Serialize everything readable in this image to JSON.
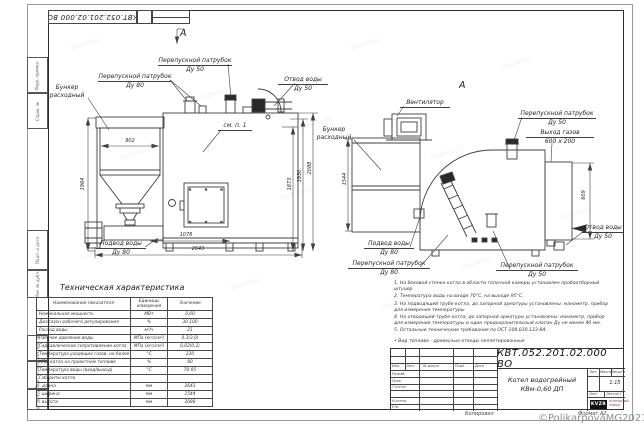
{
  "sheet": {
    "doc_number": "КВТ.052.201.02.000  ВО",
    "doc_number_top": "КВТ.052.201.02.000  ВО",
    "product_name_line1": "Котел водогрейный",
    "product_name_line2": "КВм-0,60  ДП",
    "scale_value": "1:15",
    "copied": "Копировал",
    "format": "Формат А2",
    "stamp": {
      "header_cols": {
        "izm": "Изм.",
        "list": "Лист",
        "doc": "№ докум.",
        "podp": "Подп.",
        "data": "Дата"
      },
      "rows": {
        "r1": "Разраб.",
        "r2": "Пров.",
        "r3": "Т.контр.",
        "r4": "Н.контр.",
        "r5": "Утв."
      },
      "lit": "Лит.",
      "mass": "Масса",
      "scale": "Масштаб",
      "sheet": "Лист",
      "sheets": "Листов 1"
    },
    "logo": {
      "text": "KVZR",
      "caption1": "КОТЕЛЬНЫЙ",
      "caption2": "ЗАВОД"
    },
    "margin_labels": {
      "m1": "Перв. примен.",
      "m2": "Справ. №",
      "m3": "Подп. и дата",
      "m4": "Инв. № дубл.",
      "m5": "Взам. инв. №",
      "m6": "Подп. и дата",
      "m7": "Инв. № подл."
    }
  },
  "view1": {
    "arrow_label": "А",
    "see_note": "см. п. 1",
    "labels": {
      "bunker": {
        "l1": "Бункер",
        "l2": "расходный"
      },
      "bypass80": {
        "l1": "Перепускной патрубок",
        "l2": "Ду 80"
      },
      "bypass50": {
        "l1": "Перепускной патрубок",
        "l2": "Ду 50"
      },
      "water_out": {
        "l1": "Отвод воды",
        "l2": "Ду 50"
      },
      "water_in": {
        "l1": "Подвод воды",
        "l2": "Ду 80"
      }
    },
    "dims": {
      "bunker_width": "902",
      "height_left": "1964",
      "h1873": "1873",
      "h1930": "1930",
      "h2088": "2088",
      "len1078": "1078",
      "len2643": "2643"
    }
  },
  "view2": {
    "title": "А",
    "labels": {
      "fan": "Вентилятор",
      "bunker": {
        "l1": "Бункер",
        "l2": "расходный"
      },
      "bypass50_top": {
        "l1": "Перепускной патрубок",
        "l2": "Ду 50"
      },
      "gas_out": {
        "l1": "Выход газов",
        "l2": "600 x 200"
      },
      "water_out": {
        "l1": "Отвод воды",
        "l2": "Ду 50"
      },
      "water_in": {
        "l1": "Подвод воды",
        "l2": "Ду 80"
      },
      "bypass80": {
        "l1": "Перепускной патрубок",
        "l2": "Ду 80"
      },
      "bypass50_bottom": {
        "l1": "Перепускной патрубок",
        "l2": "Ду 50"
      }
    },
    "dims": {
      "height": "1544",
      "gas_height": "609"
    }
  },
  "spec_table": {
    "title": "Техническая характеристика",
    "headers": {
      "name": "Наименование показателя",
      "unit": "Единицы измерения",
      "value": "Значение"
    },
    "rows": [
      {
        "name": "Номинальная мощность",
        "unit": "МВт",
        "value": "0,60"
      },
      {
        "name": "Диапазон рабочего регулирования",
        "unit": "%",
        "value": "30-100"
      },
      {
        "name": "Расход воды",
        "unit": "м³/ч",
        "value": "21"
      },
      {
        "name": "Рабочее давление воды",
        "unit": "МПа (кгс/см²)",
        "value": "0,3(3,0)"
      },
      {
        "name": "Гидравлическое сопротивление котла",
        "unit": "МПа (кгс/см²)",
        "value": "0,02(0,2)"
      },
      {
        "name": "Температура уходящих газов, не более",
        "unit": "°С",
        "value": "230"
      },
      {
        "name": "КПД котла на проектном топливе",
        "unit": "%",
        "value": "80"
      },
      {
        "name": "Температура воды (вход/выход)",
        "unit": "°С",
        "value": "70-95"
      },
      {
        "name": "Габариты котла",
        "unit": "",
        "value": ""
      },
      {
        "name": "- длина",
        "unit": "мм",
        "value": "2643"
      },
      {
        "name": "- ширина",
        "unit": "мм",
        "value": "1544"
      },
      {
        "name": "- высота",
        "unit": "мм",
        "value": "2088"
      }
    ]
  },
  "notes": {
    "n1": "1. На боковой стенке котла в области топочной камеры установлен пробоотборный штуцер",
    "n2": "2. Температура воды на входе 70°С, на выходе 95°С.",
    "n3": "3. На подводящей трубе котла, до запорной арматуры установлены: манометр, прибор для измерения температуры.",
    "n4": "4. На отводящей трубе котла, до запорной арматуры установлены: манометр, прибор для измерения температуры и один предохранительный клапан Ду не менее 40 мм.",
    "n5": "5. Остальные технические требования по ОСТ 108.030.133-84.",
    "fuel": "• Вид топлива - древесные отходы пеллетированные"
  },
  "watermark": {
    "copyright": "©PolikarpovaMG2021",
    "tile": "kotel-kv.kz"
  }
}
